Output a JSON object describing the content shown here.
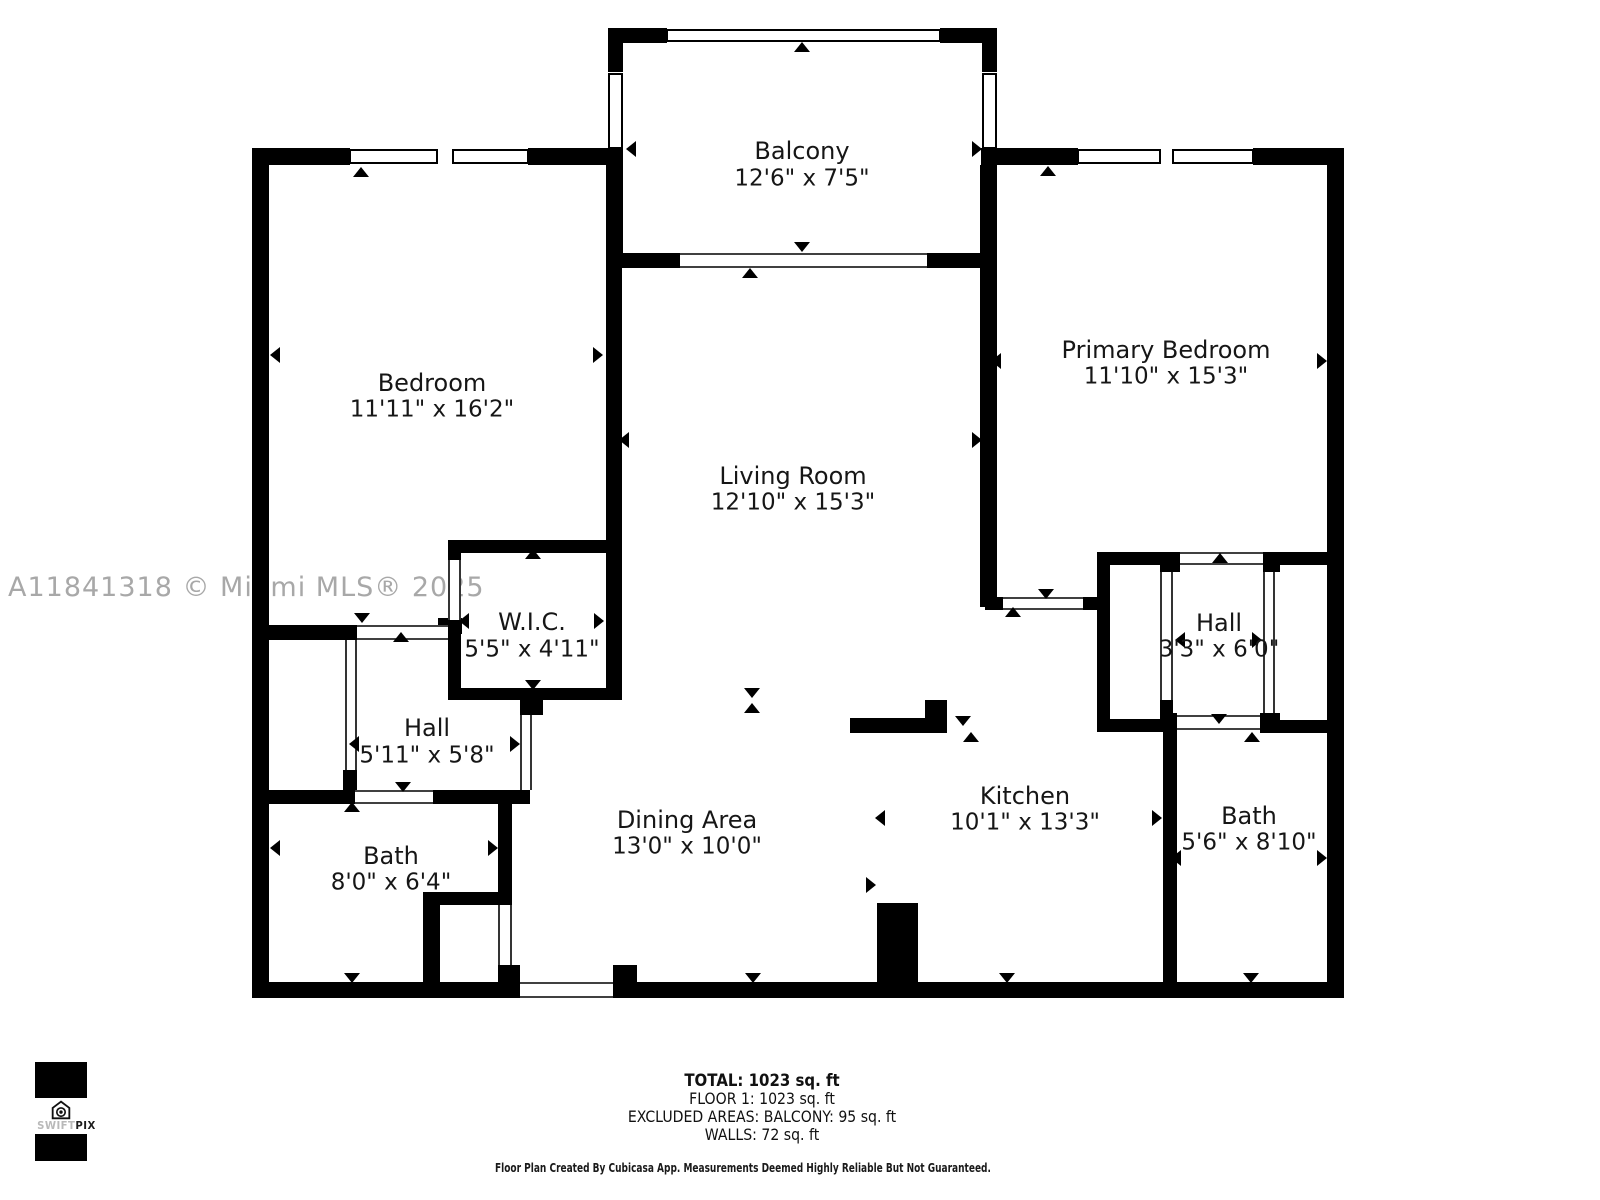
{
  "watermark": "A11841318 © Miami MLS® 2025",
  "logo": {
    "brand_light": "SWIFT",
    "brand_bold": "PIX",
    "icon": "house-camera-icon"
  },
  "footer": {
    "total": "TOTAL: 1023 sq. ft",
    "floor": "FLOOR 1: 1023 sq. ft",
    "excluded": "EXCLUDED AREAS: BALCONY: 95 sq. ft",
    "walls": "WALLS: 72 sq. ft",
    "disclaimer": "Floor Plan Created By Cubicasa App. Measurements Deemed Highly Reliable But Not Guaranteed."
  },
  "colors": {
    "wall": "#000000",
    "label": "#161616",
    "watermark": "#a8a8a8",
    "background": "#ffffff"
  },
  "rooms": [
    {
      "name": "Balcony",
      "dims": "12'6\" x 7'5\"",
      "cx": 802,
      "name_y": 152,
      "dims_y": 179
    },
    {
      "name": "Bedroom",
      "dims": "11'11\" x 16'2\"",
      "cx": 432,
      "name_y": 384,
      "dims_y": 410
    },
    {
      "name": "Living Room",
      "dims": "12'10\" x 15'3\"",
      "cx": 793,
      "name_y": 477,
      "dims_y": 503
    },
    {
      "name": "Primary Bedroom",
      "dims": "11'10\" x 15'3\"",
      "cx": 1166,
      "name_y": 351,
      "dims_y": 377
    },
    {
      "name": "W.I.C.",
      "dims": "5'5\" x 4'11\"",
      "cx": 532,
      "name_y": 623,
      "dims_y": 650
    },
    {
      "name": "Hall",
      "dims": "5'11\" x 5'8\"",
      "cx": 427,
      "name_y": 729,
      "dims_y": 756
    },
    {
      "name": "Bath",
      "dims": "8'0\" x 6'4\"",
      "cx": 391,
      "name_y": 857,
      "dims_y": 883
    },
    {
      "name": "Dining Area",
      "dims": "13'0\" x 10'0\"",
      "cx": 687,
      "name_y": 821,
      "dims_y": 847
    },
    {
      "name": "Kitchen",
      "dims": "10'1\" x 13'3\"",
      "cx": 1025,
      "name_y": 797,
      "dims_y": 823
    },
    {
      "name": "Hall",
      "dims": "3'3\" x 6'0\"",
      "cx": 1219,
      "name_y": 624,
      "dims_y": 650
    },
    {
      "name": "Bath",
      "dims": "5'6\" x 8'10\"",
      "cx": 1249,
      "name_y": 817,
      "dims_y": 843
    }
  ],
  "plan": {
    "walls": [
      [
        252,
        148,
        17,
        850
      ],
      [
        1327,
        148,
        17,
        850
      ],
      [
        252,
        148,
        98,
        17
      ],
      [
        528,
        148,
        95,
        17
      ],
      [
        981,
        148,
        97,
        17
      ],
      [
        1253,
        148,
        91,
        17
      ],
      [
        252,
        982,
        268,
        16
      ],
      [
        613,
        982,
        731,
        16
      ],
      [
        498,
        965,
        22,
        33
      ],
      [
        613,
        965,
        24,
        33
      ],
      [
        608,
        28,
        59,
        15
      ],
      [
        940,
        28,
        57,
        15
      ],
      [
        608,
        28,
        15,
        44
      ],
      [
        982,
        28,
        15,
        44
      ],
      [
        608,
        150,
        15,
        118
      ],
      [
        982,
        150,
        15,
        118
      ],
      [
        608,
        253,
        72,
        15
      ],
      [
        927,
        253,
        70,
        15
      ],
      [
        606,
        165,
        16,
        535
      ],
      [
        448,
        540,
        169,
        13
      ],
      [
        448,
        540,
        13,
        22
      ],
      [
        438,
        618,
        24,
        16
      ],
      [
        448,
        634,
        13,
        66
      ],
      [
        448,
        688,
        169,
        12
      ],
      [
        520,
        700,
        23,
        15
      ],
      [
        269,
        625,
        88,
        15
      ],
      [
        343,
        770,
        14,
        22
      ],
      [
        269,
        790,
        86,
        14
      ],
      [
        433,
        790,
        97,
        14
      ],
      [
        498,
        790,
        14,
        117
      ],
      [
        423,
        892,
        17,
        106
      ],
      [
        423,
        892,
        82,
        13
      ],
      [
        980,
        165,
        17,
        442
      ],
      [
        985,
        597,
        18,
        13
      ],
      [
        1083,
        597,
        14,
        13
      ],
      [
        1097,
        552,
        13,
        180
      ],
      [
        1097,
        552,
        76,
        13
      ],
      [
        1097,
        719,
        76,
        13
      ],
      [
        1160,
        552,
        20,
        20
      ],
      [
        1160,
        700,
        13,
        32
      ],
      [
        1263,
        552,
        17,
        20
      ],
      [
        1263,
        552,
        64,
        13
      ],
      [
        1260,
        713,
        20,
        20
      ],
      [
        1260,
        720,
        67,
        13
      ],
      [
        1163,
        713,
        14,
        285
      ],
      [
        850,
        718,
        77,
        15
      ],
      [
        925,
        700,
        22,
        33
      ],
      [
        877,
        903,
        41,
        95
      ]
    ],
    "windows": [
      [
        350,
        150,
        87,
        13
      ],
      [
        453,
        150,
        75,
        13
      ],
      [
        1078,
        150,
        82,
        13
      ],
      [
        1173,
        150,
        80,
        13
      ],
      [
        667,
        30,
        273,
        11
      ],
      [
        609,
        74,
        13,
        74
      ],
      [
        983,
        74,
        13,
        74
      ]
    ],
    "openings": [
      [
        680,
        253,
        247,
        15,
        "h"
      ],
      [
        520,
        982,
        93,
        16,
        "h"
      ],
      [
        357,
        625,
        91,
        15,
        "h"
      ],
      [
        448,
        560,
        13,
        60,
        "v"
      ],
      [
        345,
        640,
        12,
        130,
        "v"
      ],
      [
        355,
        790,
        78,
        14,
        "h"
      ],
      [
        520,
        715,
        12,
        75,
        "v"
      ],
      [
        498,
        905,
        14,
        60,
        "v"
      ],
      [
        1003,
        597,
        80,
        13,
        "h"
      ],
      [
        1160,
        572,
        13,
        128,
        "v"
      ],
      [
        1263,
        572,
        12,
        141,
        "v"
      ],
      [
        1180,
        552,
        83,
        13,
        "h"
      ],
      [
        1177,
        715,
        83,
        15,
        "h"
      ]
    ],
    "markers": [
      [
        802,
        47,
        "u"
      ],
      [
        631,
        149,
        "l"
      ],
      [
        977,
        149,
        "r"
      ],
      [
        802,
        247,
        "d"
      ],
      [
        750,
        273,
        "u"
      ],
      [
        361,
        172,
        "u"
      ],
      [
        275,
        355,
        "l"
      ],
      [
        598,
        355,
        "r"
      ],
      [
        362,
        618,
        "d"
      ],
      [
        401,
        637,
        "u"
      ],
      [
        624,
        440,
        "l"
      ],
      [
        977,
        440,
        "r"
      ],
      [
        752,
        693,
        "d"
      ],
      [
        752,
        708,
        "u"
      ],
      [
        533,
        554,
        "u"
      ],
      [
        464,
        621,
        "l"
      ],
      [
        599,
        621,
        "r"
      ],
      [
        533,
        685,
        "d"
      ],
      [
        354,
        744,
        "l"
      ],
      [
        515,
        744,
        "r"
      ],
      [
        403,
        787,
        "d"
      ],
      [
        352,
        807,
        "u"
      ],
      [
        275,
        848,
        "l"
      ],
      [
        493,
        848,
        "r"
      ],
      [
        352,
        978,
        "d"
      ],
      [
        871,
        885,
        "r"
      ],
      [
        753,
        978,
        "d"
      ],
      [
        880,
        818,
        "l"
      ],
      [
        1157,
        818,
        "r"
      ],
      [
        1007,
        978,
        "d"
      ],
      [
        963,
        721,
        "d"
      ],
      [
        971,
        737,
        "u"
      ],
      [
        1048,
        171,
        "u"
      ],
      [
        996,
        361,
        "l"
      ],
      [
        1322,
        361,
        "r"
      ],
      [
        1046,
        594,
        "d"
      ],
      [
        1013,
        612,
        "u"
      ],
      [
        1220,
        558,
        "u"
      ],
      [
        1180,
        640,
        "l"
      ],
      [
        1257,
        640,
        "r"
      ],
      [
        1219,
        719,
        "d"
      ],
      [
        1252,
        737,
        "u"
      ],
      [
        1176,
        858,
        "l"
      ],
      [
        1322,
        858,
        "r"
      ],
      [
        1251,
        978,
        "d"
      ]
    ]
  }
}
